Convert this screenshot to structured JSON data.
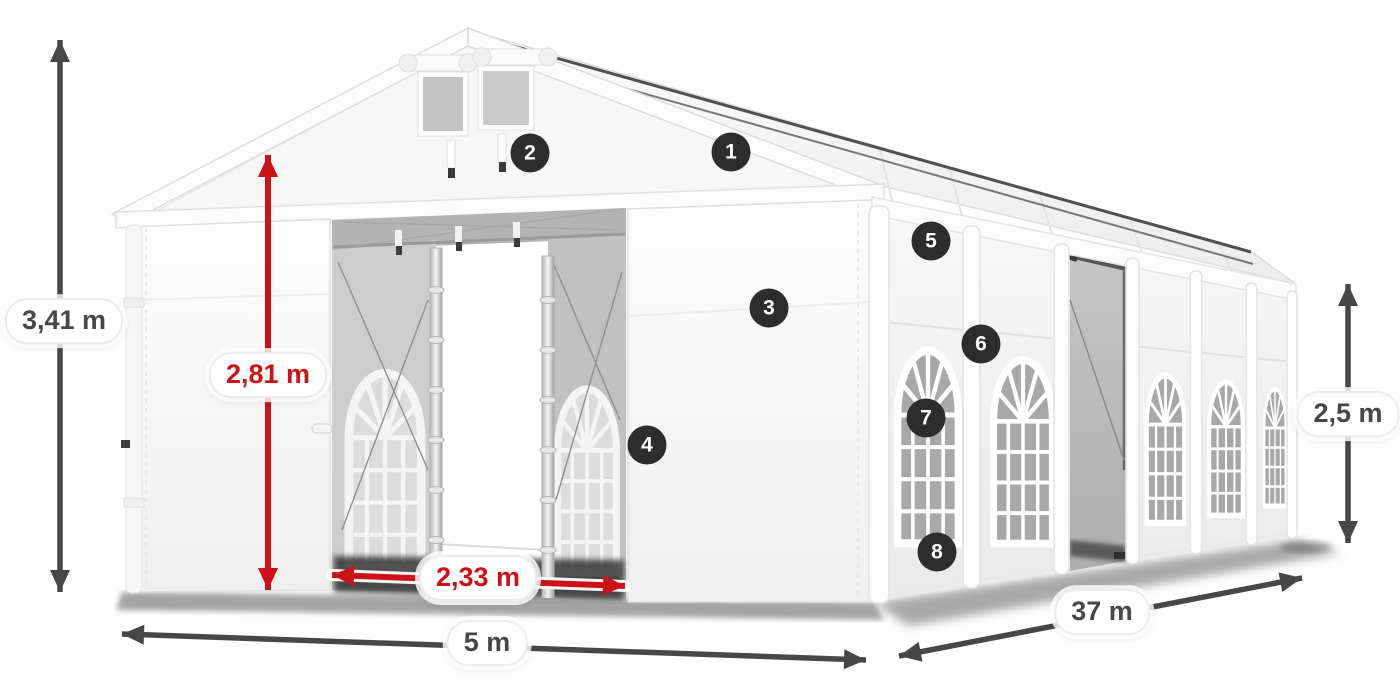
{
  "page": {
    "background": "#ffffff"
  },
  "colors": {
    "accent_red": "#cd1217",
    "dimension_dark": "#474747",
    "marker_background": "#2d2d2d",
    "marker_text": "#ffffff"
  },
  "dimensions": {
    "total_height": {
      "label": "3,41 m",
      "style": "dark"
    },
    "inner_height": {
      "label": "2,81 m",
      "style": "red"
    },
    "entrance_width": {
      "label": "2,33 m",
      "style": "red"
    },
    "front_width": {
      "label": "5 m",
      "style": "dark"
    },
    "length": {
      "label": "37 m",
      "style": "dark"
    },
    "side_height": {
      "label": "2,5 m",
      "style": "dark"
    }
  },
  "markers": [
    "1",
    "2",
    "3",
    "4",
    "5",
    "6",
    "7",
    "8"
  ]
}
